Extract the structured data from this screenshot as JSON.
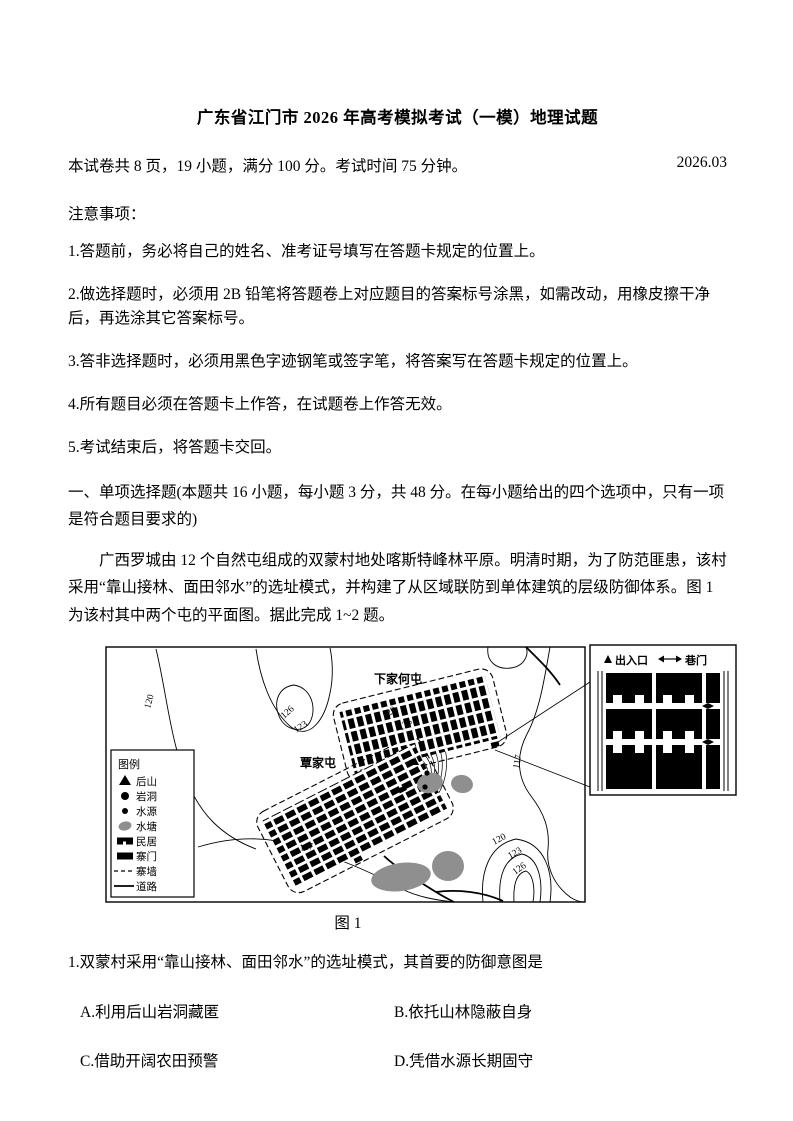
{
  "header": {
    "title": "广东省江门市 2026 年高考模拟考试（一模）地理试题",
    "info": "本试卷共 8 页，19 小题，满分 100 分。考试时间 75 分钟。",
    "date": "2026.03"
  },
  "notices": {
    "title": "注意事项：",
    "items": [
      "1.答题前，务必将自己的姓名、准考证号填写在答题卡规定的位置上。",
      "2.做选择题时，必须用 2B 铅笔将答题卷上对应题目的答案标号涂黑，如需改动，用橡皮擦干净后，再选涂其它答案标号。",
      "3.答非选择题时，必须用黑色字迹钢笔或签字笔，将答案写在答题卡规定的位置上。",
      "4.所有题目必须在答题卡上作答，在试题卷上作答无效。",
      "5.考试结束后，将答题卡交回。"
    ]
  },
  "section": {
    "header": "一、单项选择题(本题共 16 小题，每小题 3 分，共 48 分。在每小题给出的四个选项中，只有一项是符合题目要求的)"
  },
  "passage": {
    "text": "广西罗城由 12 个自然屯组成的双蒙村地处喀斯特峰林平原。明清时期，为了防范匪患，该村采用“靠山接林、面田邻水”的选址模式，并构建了从区域联防到单体建筑的层级防御体系。图 1 为该村其中两个屯的平面图。据此完成 1~2 题。"
  },
  "figure": {
    "caption": "图 1",
    "legend": {
      "title": "图例",
      "items": [
        "后山",
        "岩洞",
        "水源",
        "水塘",
        "民居",
        "寨门",
        "寨墙",
        "道路"
      ]
    },
    "villages": {
      "xiajiahe": "下家何屯",
      "qinjia": "覃家屯"
    },
    "contours": {
      "left": "120",
      "u": "123",
      "u_inner": "126",
      "hill_a": "120",
      "hill_b": "123",
      "right": "117",
      "bottom": "117",
      "br_a": "120",
      "br_b": "123",
      "br_c": "126"
    },
    "inset": {
      "entrance": "出入口",
      "alley_gate": "巷门"
    },
    "colors": {
      "pond_gray": "#8f8f8f",
      "ink": "#000000"
    }
  },
  "question1": {
    "stem": "1.双蒙村采用“靠山接林、面田邻水”的选址模式，其首要的防御意图是",
    "options": [
      "A.利用后山岩洞藏匿",
      "B.依托山林隐蔽自身",
      "C.借助开阔农田预警",
      "D.凭借水源长期固守"
    ]
  }
}
